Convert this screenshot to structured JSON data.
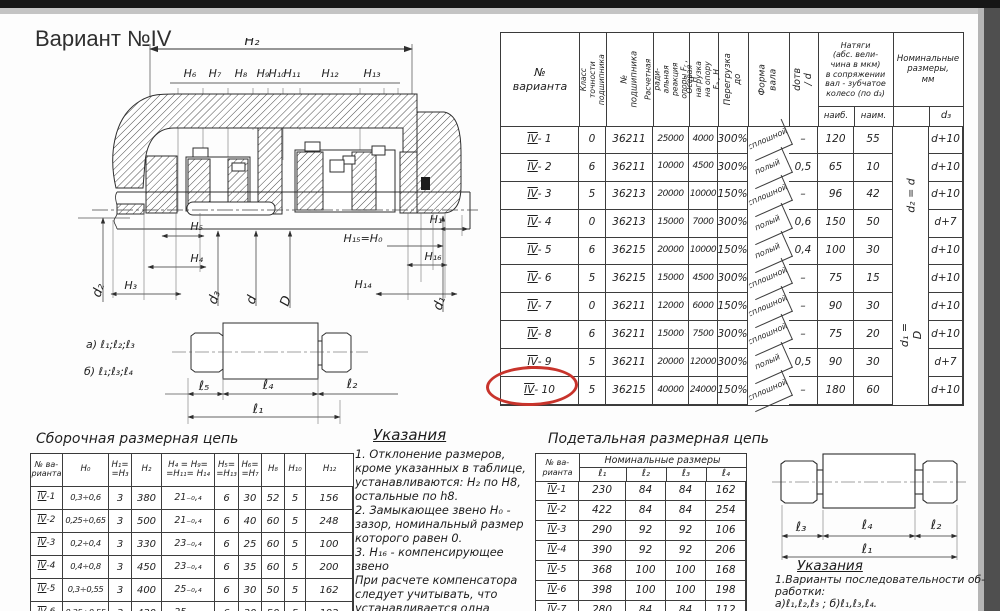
{
  "page_title": "Вариант №IV",
  "main_table": {
    "headers": {
      "variant": "№\nварианта",
      "cls": "Класс точности\nподшипника",
      "brg": "№ подшипника",
      "fr": "Расчетная ради-\nальная реакция\nопоры Fᵣ , Н",
      "fa": "Осевая нагрузка\nна опору Fₐ , Н",
      "ov": "Перегрузка до",
      "shape": "Форма вала",
      "dod": "dотв / d",
      "nat": "Натяги\n(абс. вели-\nчина в мкм)\nв сопряжении\nвал - зубчатое\nколесо (по d₃)",
      "naib": "наиб.",
      "naim": "наим.",
      "nom": "Номинальные\nразмеры,\nмм",
      "d3": "d₃",
      "merge_top": "d₂ = d",
      "merge_bottom": "d₁ = D"
    },
    "rows": [
      [
        "IV - 1",
        "0",
        "36211",
        "25000",
        "4000",
        "300%",
        "сплошной",
        "–",
        "120",
        "55",
        "",
        "d+10"
      ],
      [
        "IV - 2",
        "6",
        "36211",
        "10000",
        "4500",
        "300%",
        "полый",
        "0,5",
        "65",
        "10",
        "",
        "d+10"
      ],
      [
        "IV - 3",
        "5",
        "36213",
        "20000",
        "10000",
        "150%",
        "сплошной",
        "–",
        "96",
        "42",
        "",
        "d+10"
      ],
      [
        "IV - 4",
        "0",
        "36213",
        "15000",
        "7000",
        "300%",
        "полый",
        "0,6",
        "150",
        "50",
        "",
        "d+7"
      ],
      [
        "IV - 5",
        "6",
        "36215",
        "20000",
        "10000",
        "150%",
        "полый",
        "0,4",
        "100",
        "30",
        "",
        "d+10"
      ],
      [
        "IV - 6",
        "5",
        "36215",
        "15000",
        "4500",
        "300%",
        "сплошной",
        "–",
        "75",
        "15",
        "",
        "d+10"
      ],
      [
        "IV - 7",
        "0",
        "36211",
        "12000",
        "6000",
        "150%",
        "сплошной",
        "–",
        "90",
        "30",
        "",
        "d+10"
      ],
      [
        "IV - 8",
        "6",
        "36211",
        "15000",
        "7500",
        "300%",
        "сплошной",
        "–",
        "75",
        "20",
        "",
        "d+10"
      ],
      [
        "IV - 9",
        "5",
        "36211",
        "20000",
        "12000",
        "300%",
        "полый",
        "0,5",
        "90",
        "30",
        "",
        "d+7"
      ],
      [
        "IV - 10",
        "5",
        "36215",
        "40000",
        "24000",
        "150%",
        "сплошной",
        "–",
        "180",
        "60",
        "",
        "d+10"
      ]
    ]
  },
  "assembly_table": {
    "title": "Сборочная размерная цепь",
    "headers": [
      "№ ва-\nрианта",
      "H₀",
      "H₁=\n=H₃",
      "H₂",
      "H₄ = H₉=\n=H₁₁= H₁₄",
      "H₅=\n=H₁₃",
      "H₆=\n=H₇",
      "H₈",
      "H₁₀",
      "H₁₂"
    ],
    "rows": [
      [
        "IV-1",
        "0,3÷0,6",
        "3",
        "380",
        "21₋₀,₄",
        "6",
        "30",
        "52",
        "5",
        "156"
      ],
      [
        "IV-2",
        "0,25÷0,65",
        "3",
        "500",
        "21₋₀,₄",
        "6",
        "40",
        "60",
        "5",
        "248"
      ],
      [
        "IV-3",
        "0,2÷0,4",
        "3",
        "330",
        "23₋₀,₄",
        "6",
        "25",
        "60",
        "5",
        "100"
      ],
      [
        "IV-4",
        "0,4÷0,8",
        "3",
        "450",
        "23₋₀,₄",
        "6",
        "35",
        "60",
        "5",
        "200"
      ],
      [
        "IV-5",
        "0,3÷0,55",
        "3",
        "400",
        "25₋₀,₄",
        "6",
        "30",
        "50",
        "5",
        "162"
      ],
      [
        "IV-6",
        "0,25÷0,55",
        "3",
        "430",
        "25₋₀,₄",
        "6",
        "30",
        "50",
        "5",
        "192"
      ]
    ]
  },
  "detail_table": {
    "title": "Подетальная размерная цепь",
    "variant_header": "№ ва-\nрианта",
    "group_header": "Номинальные   размеры",
    "col_headers": [
      "ℓ₁",
      "ℓ₂",
      "ℓ₃",
      "ℓ₄"
    ],
    "rows": [
      [
        "IV-1",
        "230",
        "84",
        "84",
        "162"
      ],
      [
        "IV-2",
        "422",
        "84",
        "84",
        "254"
      ],
      [
        "IV-3",
        "290",
        "92",
        "92",
        "106"
      ],
      [
        "IV-4",
        "390",
        "92",
        "92",
        "206"
      ],
      [
        "IV-5",
        "368",
        "100",
        "100",
        "168"
      ],
      [
        "IV-6",
        "398",
        "100",
        "100",
        "198"
      ],
      [
        "IV-7",
        "280",
        "84",
        "84",
        "112"
      ]
    ]
  },
  "instructions": {
    "title": "Указания",
    "lines": [
      "1. Отклонение размеров,",
      "кроме указанных в таблице,",
      "устанавливаются: H₂ по H8,",
      "остальные по h8.",
      "2. Замыкающее звено H₀ -",
      "зазор, номинальный размер",
      "которого равен 0.",
      "3. Н₁₆ - компенсирующее звено",
      "При расчете компенсатора",
      "следует учитывать, что",
      "устанавливается одна"
    ]
  },
  "right_notes": {
    "title": "Указания",
    "lines": [
      "1.Варианты последовательности об-",
      "работки:",
      "а)ℓ₁,ℓ₂,ℓ₃ ;     б)ℓ₁,ℓ₃,ℓ₄."
    ]
  },
  "drawing": {
    "dims_top": [
      "H₆",
      "H₇",
      "H₈",
      "H₉",
      "H₁₀",
      "H₁₁",
      "H₁₂",
      "H₁₃"
    ],
    "h2": "H₂",
    "h5": "H₅",
    "h4": "H₄",
    "h3": "H₃",
    "h1": "H₁",
    "h15": "H₁₅=H₀",
    "h16": "H₁₆",
    "h14": "H₁₄",
    "d2": "d₂",
    "d3": "d₃",
    "d": "d",
    "D": "D",
    "d1": "d₁",
    "note_a": "а) ℓ₁;ℓ₂;ℓ₃",
    "note_b": "б) ℓ₁;ℓ₃;ℓ₄",
    "l5": "ℓ₅",
    "l4": "ℓ₄",
    "l2": "ℓ₂",
    "l1": "ℓ₁"
  },
  "rshaft": {
    "l3": "ℓ₃",
    "l4": "ℓ₄",
    "l2": "ℓ₂",
    "l1": "ℓ₁"
  }
}
